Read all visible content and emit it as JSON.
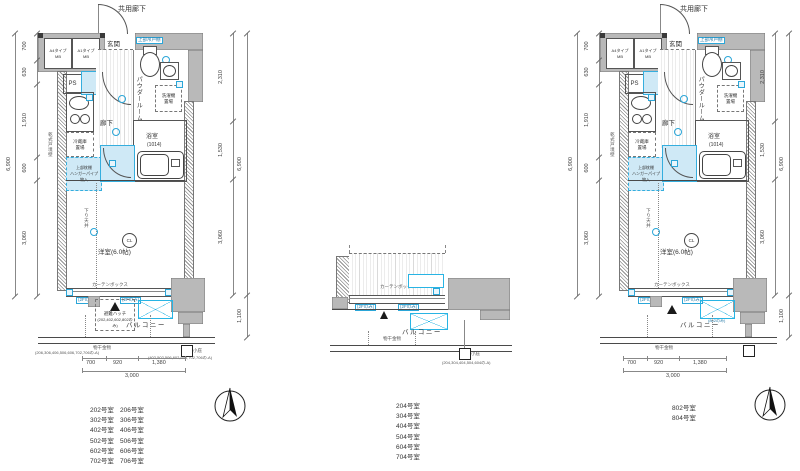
{
  "colors": {
    "accent_blue": "#2ba6d8",
    "light_blue_fill": "#cfe9f6",
    "wall_gray": "#b9b9b9",
    "line_gray": "#555555",
    "background": "#ffffff"
  },
  "unit": {
    "corridor": "共用廊下",
    "mb_a4": "A4タイプ",
    "mb_a1": "A1タイプ",
    "mb": "MB",
    "genkan": "玄関",
    "ps": "PS",
    "upper_cabinet": "上部吊戸棚",
    "powder": "パウダールーム",
    "washer": "洗濯機置場",
    "bath": "浴室",
    "bath_size": "(1014)",
    "hallway": "廊下",
    "fridge": "冷蔵庫置場",
    "closet_l1": "上部枕棚",
    "closet_l2": "ハンガーパイプ",
    "closet_l3": "物入",
    "boundary_wall": "乾式戸境壁",
    "down_ceiling": "下り天井",
    "cl": "CL",
    "room": "洋室(6.0帖)",
    "curtain_box": "カーテンボックス",
    "balcony": "バルコニー",
    "hatch": "避難ハッチ"
  },
  "annotations": {
    "hatch_note": "(202,402,602,802のみ)",
    "monohoshi": "物干金物",
    "monohoshi_note": "(206,306,406,506,606,702,706の-A)",
    "kobisashi": "小庇",
    "kobisashi_note": "(402,502,506,602,606,702,706の-A)",
    "middle_note": "(204,304,404,504,604の-A)",
    "only_802": "(802のみ)",
    "only_2f": "(2Fのみ)"
  },
  "dims": {
    "left": [
      "700",
      "630",
      "1,910",
      "600",
      "3,060"
    ],
    "left_total": "6,900",
    "right": [
      "2,310",
      "1,530",
      "3,060"
    ],
    "right_total": "6,900",
    "balcony_depth": "1,100",
    "bottom": [
      "700",
      "920",
      "1,380"
    ],
    "bottom_total": "3,000"
  },
  "room_lists": {
    "left": [
      [
        "202号室",
        "206号室"
      ],
      [
        "302号室",
        "306号室"
      ],
      [
        "402号室",
        "406号室"
      ],
      [
        "502号室",
        "506号室"
      ],
      [
        "602号室",
        "606号室"
      ],
      [
        "702号室",
        "706号室"
      ]
    ],
    "middle": [
      "204号室",
      "304号室",
      "404号室",
      "504号室",
      "604号室",
      "704号室"
    ],
    "right": [
      "802号室",
      "804号室"
    ]
  }
}
